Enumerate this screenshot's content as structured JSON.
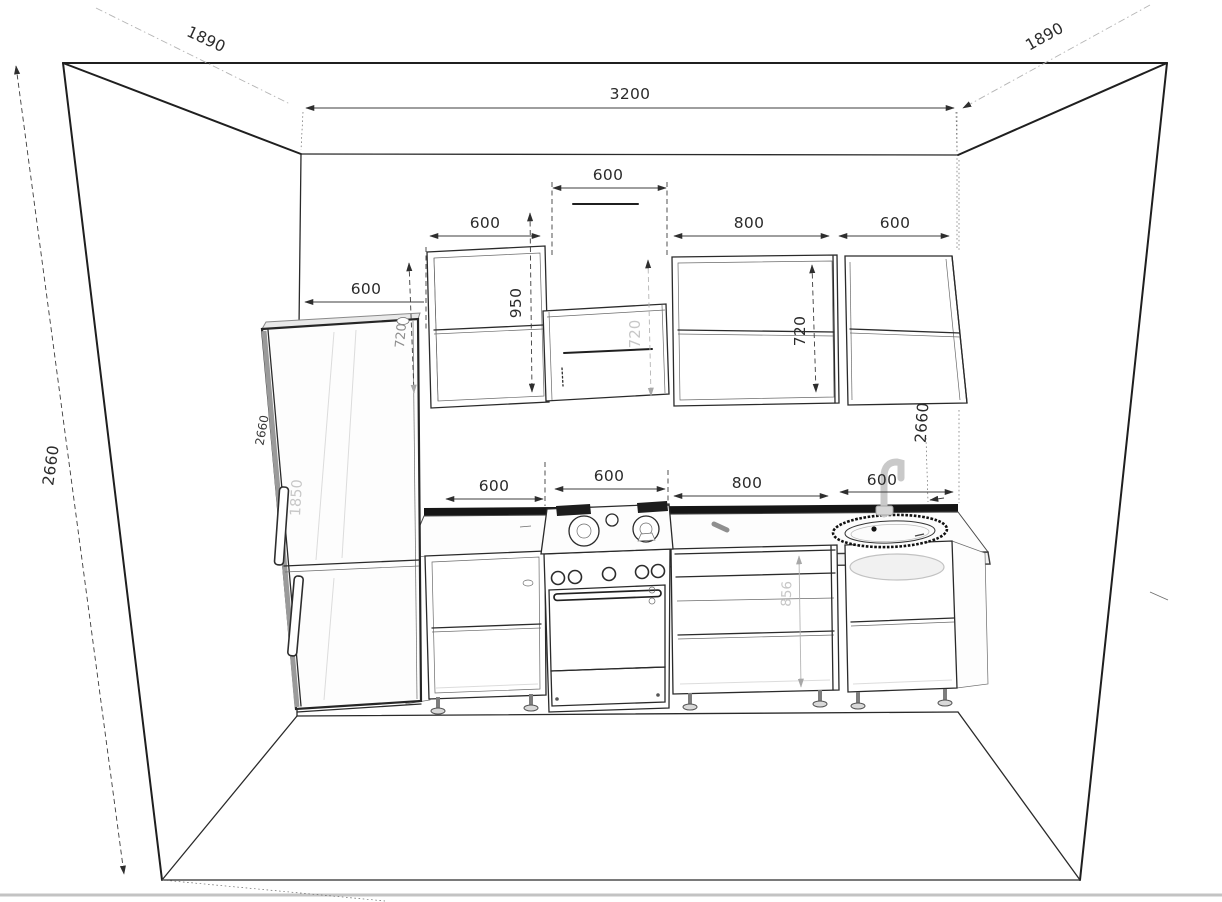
{
  "drawing": {
    "type": "kitchen-elevation-perspective",
    "units": "mm",
    "room": {
      "width": "3200",
      "height_left": "2660",
      "depth_left": "1890",
      "depth_right": "1890",
      "height_right": "2660"
    },
    "upper_row": {
      "left_wall_offset": "600",
      "wall_cabinet_left_width": "600",
      "wall_cabinet_left_height": "950",
      "fridge_gap_height": "720",
      "hood_width": "600",
      "hood_cabinet_height": "720",
      "wall_cabinet_800_width": "800",
      "wall_cabinet_right_width": "600",
      "wall_cabinet_right_height": "720"
    },
    "base_row": {
      "base_cabinet_1_width": "600",
      "stove_width": "600",
      "base_cabinet_2_width": "800",
      "base_cabinet_2_height": "856",
      "sink_cabinet_width": "600"
    },
    "fridge": {
      "height": "1850",
      "niche_height": "2660"
    }
  }
}
